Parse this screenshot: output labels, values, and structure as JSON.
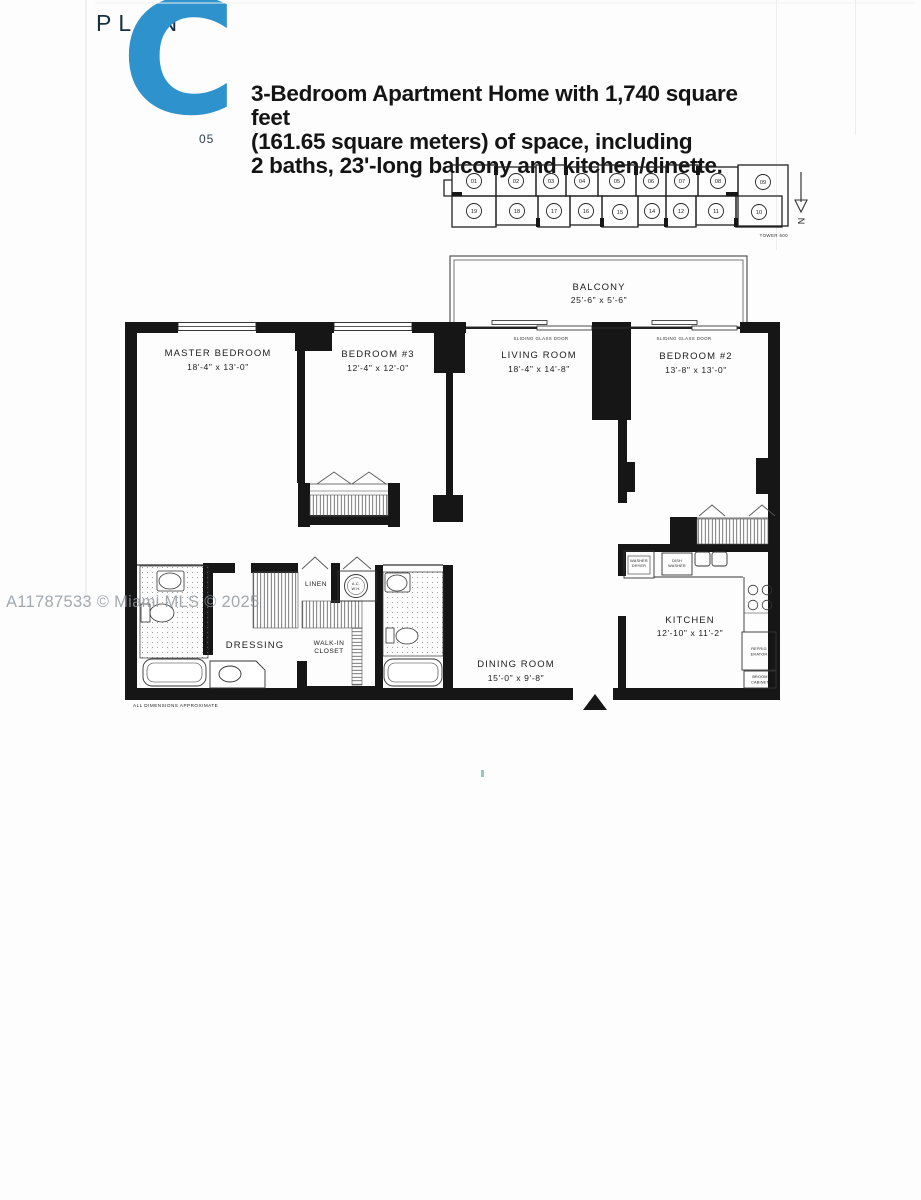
{
  "header": {
    "plan_word": "PLAN",
    "plan_letter": "C",
    "plan_code": "05",
    "desc1": "3-Bedroom Apartment Home with 1,740 square feet",
    "desc2": "(161.65 square meters) of space, including",
    "desc3": "2 baths, 23'-long balcony and kitchen/dinette."
  },
  "key_plan": {
    "tower": "TOWER 600",
    "north": "N",
    "top_units": [
      "01",
      "02",
      "03",
      "04",
      "05",
      "06",
      "07",
      "08",
      "09"
    ],
    "bottom_units": [
      "19",
      "18",
      "17",
      "16",
      "15",
      "14",
      "12",
      "11",
      "10"
    ]
  },
  "plan": {
    "balcony_name": "BALCONY",
    "balcony_dims": "25'-6\" x 5'-6\"",
    "sliding_door": "SLIDING GLASS DOOR",
    "master_name": "MASTER BEDROOM",
    "master_dims": "18'-4\" x 13'-0\"",
    "bed3_name": "BEDROOM #3",
    "bed3_dims": "12'-4\" x 12'-0\"",
    "living_name": "LIVING ROOM",
    "living_dims": "18'-4\" x 14'-8\"",
    "bed2_name": "BEDROOM #2",
    "bed2_dims": "13'-8\" x 13'-0\"",
    "dining_name": "DINING ROOM",
    "dining_dims": "15'-0\" x 9'-8\"",
    "kitchen_name": "KITCHEN",
    "kitchen_dims": "12'-10\" x 11'-2\"",
    "dressing": "DRESSING",
    "walkin1": "WALK-IN",
    "walkin2": "CLOSET",
    "linen": "LINEN",
    "ac1": "A.C.",
    "ac2": "W.H.",
    "washer1": "WASHER",
    "washer2": "DRYER",
    "dish1": "DISH",
    "dish2": "WASHER",
    "refrig1": "REFRIG",
    "refrig2": "ERATOR",
    "broom1": "BROOM",
    "broom2": "CABINET",
    "footnote": "ALL DIMENSIONS APPROXIMATE"
  },
  "watermark": {
    "text": "A11787533 © Miami MLS © 2025"
  },
  "colors": {
    "accent_blue": "#2e93cc",
    "wall_black": "#161616",
    "watermark_gray": "#8e979e"
  }
}
